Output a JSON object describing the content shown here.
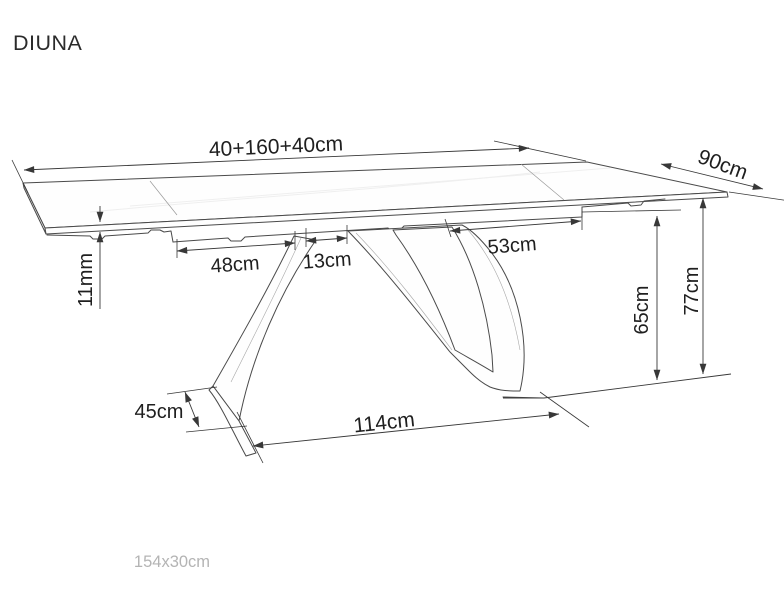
{
  "title": "DIUNA",
  "footer_note": "154x30cm",
  "colors": {
    "background": "#ffffff",
    "drawing_line": "#4a4a4a",
    "dimension_line": "#383838",
    "dimension_text": "#1f1f1f",
    "footer_text": "#b4b4b4"
  },
  "drawing": {
    "subject": "extendable-table-technical-drawing",
    "dimensions": {
      "top_length": "40+160+40cm",
      "top_depth": "90cm",
      "top_thickness": "11mm",
      "underframe_left_offset": "48cm",
      "base_top_gap": "13cm",
      "underframe_right_offset": "53cm",
      "underframe_clearance_height": "65cm",
      "table_height": "77cm",
      "foot_depth": "45cm",
      "base_span": "114cm"
    }
  }
}
